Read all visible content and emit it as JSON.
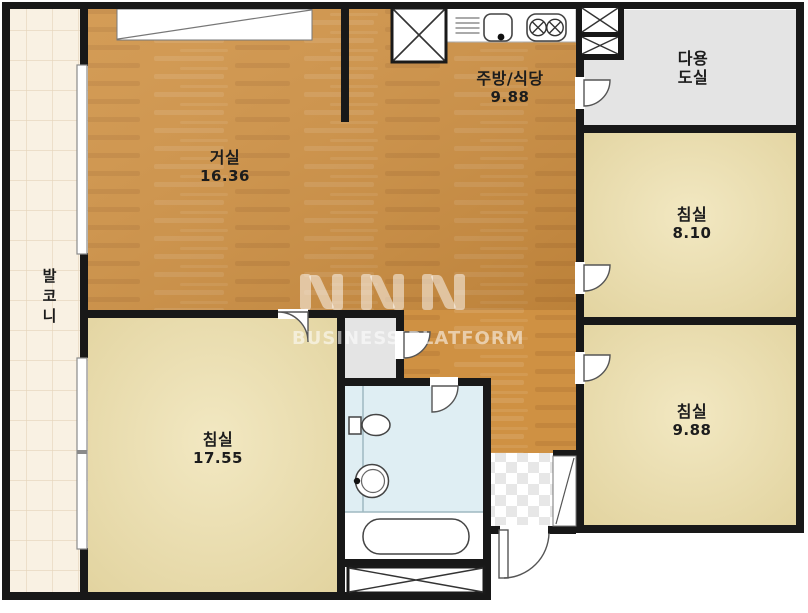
{
  "rooms": {
    "living_room": {
      "label": "거실",
      "area": "16.36"
    },
    "kitchen_dining": {
      "label": "주방/식당",
      "area": "9.88"
    },
    "utility_room": {
      "label_line1": "다용",
      "label_line2": "도실"
    },
    "bedroom_top_right": {
      "label": "침실",
      "area": "8.10"
    },
    "bedroom_bottom_right": {
      "label": "침실",
      "area": "9.88"
    },
    "bedroom_left": {
      "label": "침실",
      "area": "17.55"
    },
    "balcony": {
      "label": "발코니"
    }
  },
  "watermark": {
    "text": "BUSINESS PLATFORM"
  },
  "colors": {
    "wall": "#181818",
    "wood_floor": "#cf9143",
    "bedroom_floor": "#e9dcae",
    "balcony_floor": "#f9f1e3",
    "utility_floor": "#e4e4e4",
    "bathroom_floor": "#dfeef3"
  }
}
